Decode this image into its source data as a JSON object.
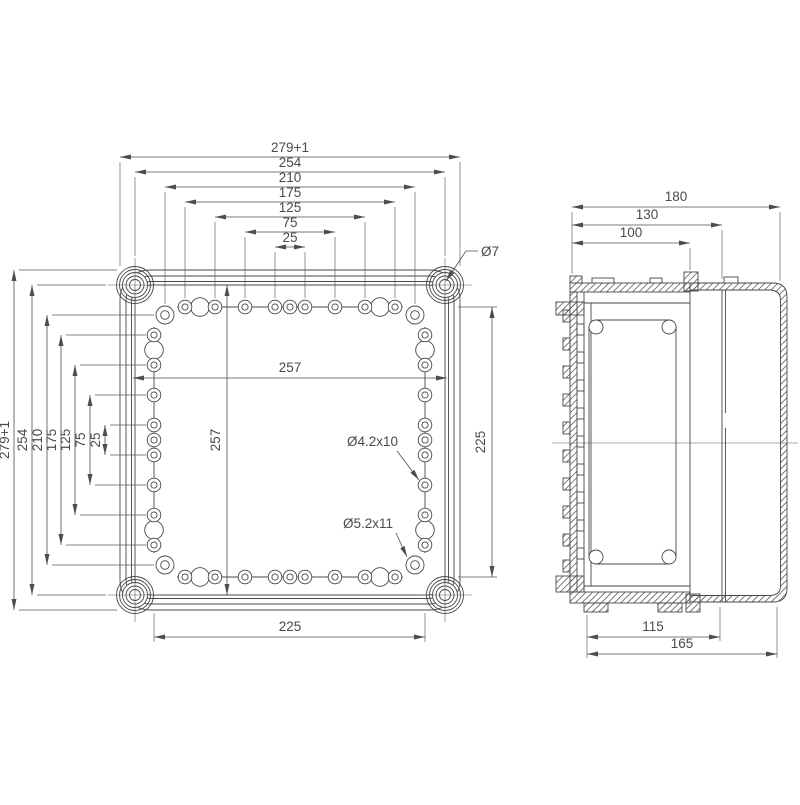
{
  "drawing": {
    "front_view": {
      "top_dims": [
        "279+1",
        "254",
        "210",
        "175",
        "125",
        "75",
        "25"
      ],
      "left_dims": [
        "279+1",
        "254",
        "210",
        "175",
        "125",
        "75",
        "25"
      ],
      "inner_width": "257",
      "inner_height": "257",
      "right_dim": "225",
      "bottom_dim": "225",
      "corner_hole_callout": "Ø7",
      "small_hole_callout": "Ø4.2x10",
      "large_hole_callout": "Ø5.2x11"
    },
    "side_view": {
      "top_dims": [
        "180",
        "130",
        "100"
      ],
      "bottom_dims": [
        "115",
        "165"
      ]
    },
    "colors": {
      "line": "#474747",
      "text": "#4a4a4a",
      "background": "#ffffff"
    }
  }
}
